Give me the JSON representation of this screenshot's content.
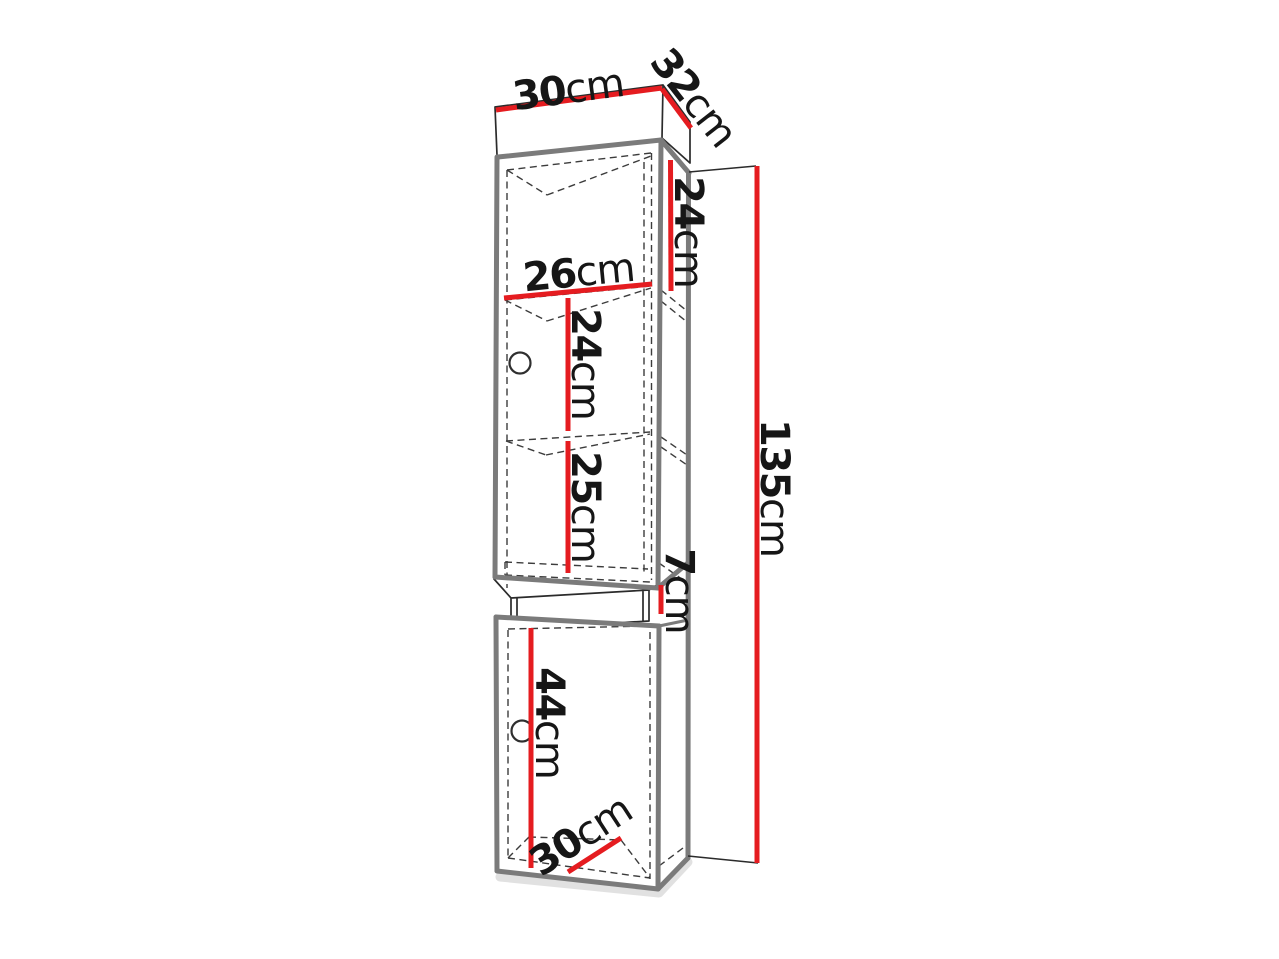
{
  "page": {
    "background": "#ffffff"
  },
  "colors": {
    "dimension_line": "#e51c20",
    "cabinet_outline": "#7b7b7b",
    "detail_line": "#2b2b2b",
    "label_text": "#161616"
  },
  "figure": {
    "dimensions": {
      "top_width": {
        "value": "30",
        "unit": "cm"
      },
      "top_depth": {
        "value": "32",
        "unit": "cm"
      },
      "top_section_height": {
        "value": "24",
        "unit": "cm"
      },
      "inner_width": {
        "value": "26",
        "unit": "cm"
      },
      "middle_section_height": {
        "value": "24",
        "unit": "cm"
      },
      "lower_section_height": {
        "value": "25",
        "unit": "cm"
      },
      "niche_height": {
        "value": "7",
        "unit": "cm"
      },
      "door_section_height": {
        "value": "44",
        "unit": "cm"
      },
      "bottom_depth": {
        "value": "30",
        "unit": "cm"
      },
      "total_height": {
        "value": "135",
        "unit": "cm"
      }
    }
  }
}
